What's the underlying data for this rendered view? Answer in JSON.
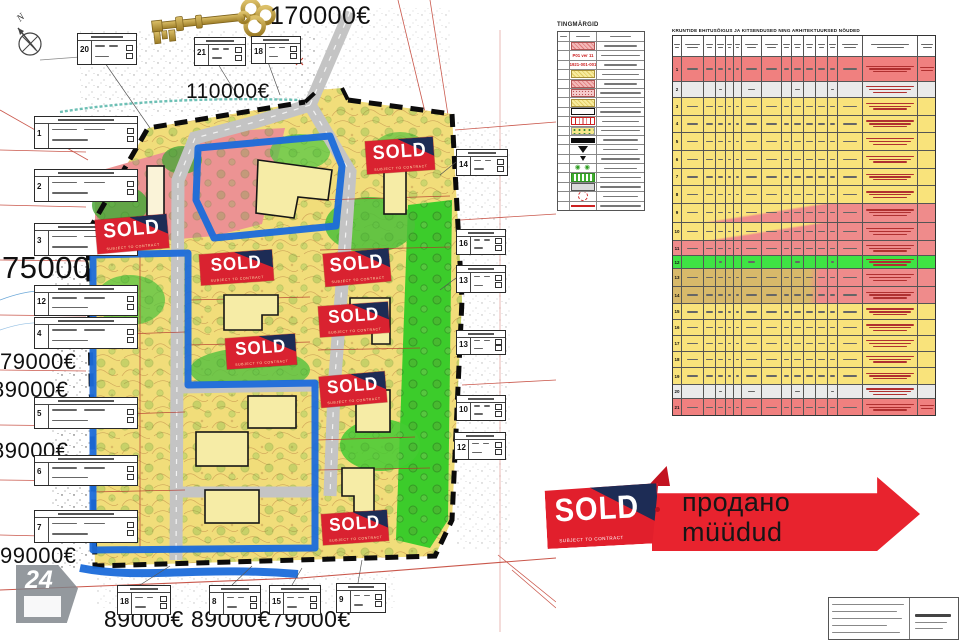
{
  "map": {
    "compass_label": "N",
    "key_icon": "golden-skeleton-key",
    "prices": [
      "170000€",
      "110000€",
      "75000",
      "79000€",
      "89000€",
      "89000€",
      "99000€",
      "89000€",
      "89000€",
      "79000€"
    ],
    "sold_badge": {
      "label": "SOLD",
      "sub_label": "SUBJECT TO CONTRACT",
      "count": 8
    },
    "plot_table_numbers": [
      "20",
      "21",
      "18",
      "1",
      "2",
      "3",
      "12",
      "4",
      "5",
      "6",
      "7",
      "14",
      "16",
      "13",
      "13",
      "10",
      "12",
      "18",
      "8",
      "15",
      "9"
    ],
    "watermark_label": "24"
  },
  "legend": {
    "title": "TINGMÄRGID",
    "rows": [
      {
        "symbol": "pink-hatch-swatch",
        "code": ""
      },
      {
        "symbol": "red-code",
        "code": "P01 ver 11"
      },
      {
        "symbol": "red-code",
        "code": "51921-001-0018"
      },
      {
        "symbol": "yellow-hatch",
        "code": ""
      },
      {
        "symbol": "pink-hatch",
        "code": ""
      },
      {
        "symbol": "pink-dots",
        "code": ""
      },
      {
        "symbol": "yellow-hatch",
        "code": ""
      },
      {
        "symbol": "black-outline",
        "code": ""
      },
      {
        "symbol": "red-ticks",
        "code": ""
      },
      {
        "symbol": "yellow-circles",
        "code": ""
      },
      {
        "symbol": "black-bar",
        "code": ""
      },
      {
        "symbol": "triangle-down",
        "code": ""
      },
      {
        "symbol": "triangle-small",
        "code": ""
      },
      {
        "symbol": "green-rings",
        "code": "◉ ◉"
      },
      {
        "symbol": "green-stripes",
        "code": ""
      },
      {
        "symbol": "gray-road",
        "code": ""
      },
      {
        "symbol": "red-dashed-circle",
        "code": ""
      },
      {
        "symbol": "red-line",
        "code": ""
      }
    ]
  },
  "rights_table": {
    "title": "KRUNTIDE EHITUSÕIGUS JA KITSENDUSED NING ARHITEKTUURSED NÕUDED",
    "rows": [
      {
        "no": "1",
        "tone": "red"
      },
      {
        "no": "2",
        "tone": "gray"
      },
      {
        "no": "3",
        "tone": "yellow"
      },
      {
        "no": "4",
        "tone": "yellow"
      },
      {
        "no": "5",
        "tone": "yellow"
      },
      {
        "no": "6",
        "tone": "yellow"
      },
      {
        "no": "7",
        "tone": "yellow"
      },
      {
        "no": "8",
        "tone": "yellow"
      },
      {
        "no": "9",
        "tone": "pink-diag"
      },
      {
        "no": "10",
        "tone": "pink-diag"
      },
      {
        "no": "11",
        "tone": "pink"
      },
      {
        "no": "12",
        "tone": "green"
      },
      {
        "no": "13",
        "tone": "tan-diag"
      },
      {
        "no": "14",
        "tone": "tan-diag"
      },
      {
        "no": "15",
        "tone": "yellow"
      },
      {
        "no": "16",
        "tone": "yellow"
      },
      {
        "no": "17",
        "tone": "yellow"
      },
      {
        "no": "18",
        "tone": "yellow"
      },
      {
        "no": "19",
        "tone": "yellow"
      },
      {
        "no": "20",
        "tone": "gray"
      },
      {
        "no": "21",
        "tone": "red"
      }
    ]
  },
  "banner": {
    "sold": "SOLD",
    "subject": "SUBJECT TO CONTRACT",
    "line_ru": "продано",
    "line_et": "müüdud"
  }
}
